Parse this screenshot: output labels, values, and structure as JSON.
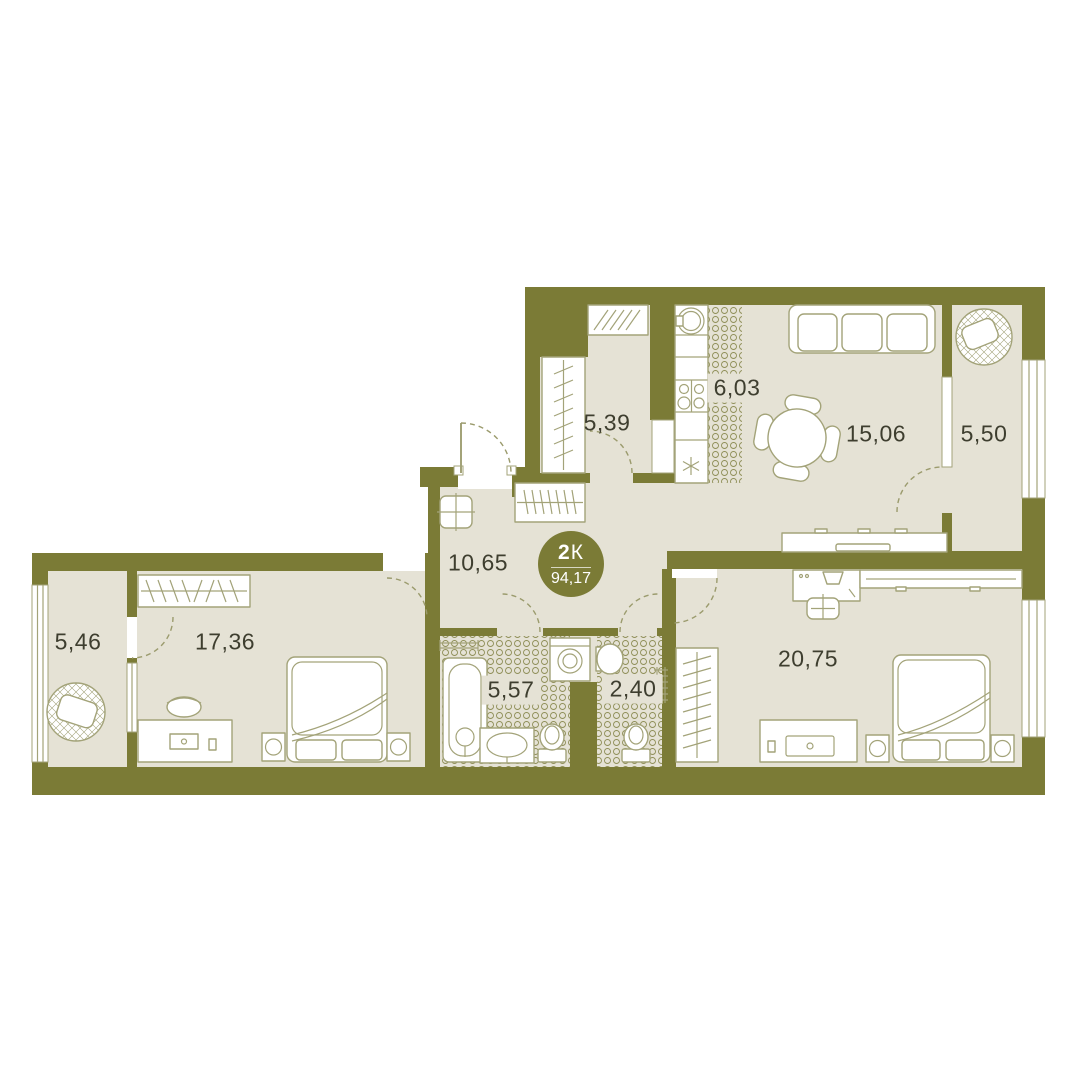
{
  "apartment": {
    "type_number": "2",
    "type_letter": "К",
    "total_area": "94,17"
  },
  "rooms": [
    {
      "id": "hallway",
      "area_label": "5,39"
    },
    {
      "id": "kitchen",
      "area_label": "6,03"
    },
    {
      "id": "living-room",
      "area_label": "15,06"
    },
    {
      "id": "balcony-right",
      "area_label": "5,50"
    },
    {
      "id": "corridor",
      "area_label": "10,65"
    },
    {
      "id": "balcony-left",
      "area_label": "5,46"
    },
    {
      "id": "bedroom-left",
      "area_label": "17,36"
    },
    {
      "id": "bathroom",
      "area_label": "5,57"
    },
    {
      "id": "toilet",
      "area_label": "2,40"
    },
    {
      "id": "bedroom-right",
      "area_label": "20,75"
    }
  ],
  "colors": {
    "wall": "#7b7b36",
    "floor": "#e5e2d5",
    "furn": "#a3a379",
    "dash": "#9b9b6d",
    "tile": "#8f8f58",
    "text": "#3e3e2f",
    "badge_text": "#ffffff"
  }
}
